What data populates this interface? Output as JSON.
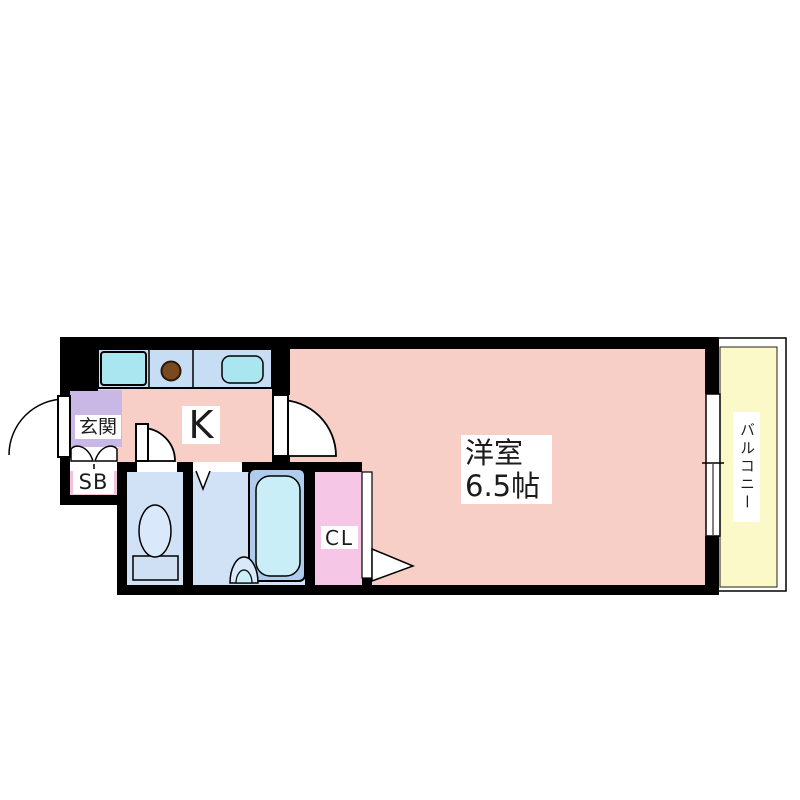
{
  "floor_plan": {
    "labels": {
      "entrance": "玄関",
      "shoe_box": "SB",
      "kitchen": "K",
      "closet": "CL",
      "room_type": "洋室",
      "room_size": "6.5帖",
      "balcony": "バルコニー"
    },
    "colors": {
      "wall": "#000000",
      "main_room": "#f7cfc6",
      "entrance": "#c9b7e6",
      "shoe_box": "#f3c0df",
      "closet": "#f6c6e6",
      "wet_area_floor": "#d2e2f6",
      "kitchen_counter": "#c6ddf3",
      "sink": "#a9e6f0",
      "bathtub_outer": "#afccec",
      "bathtub_inner": "#c9eef8",
      "stove_burner": "#7a4a1f",
      "balcony": "#fcf9c8",
      "background": "#ffffff"
    }
  }
}
